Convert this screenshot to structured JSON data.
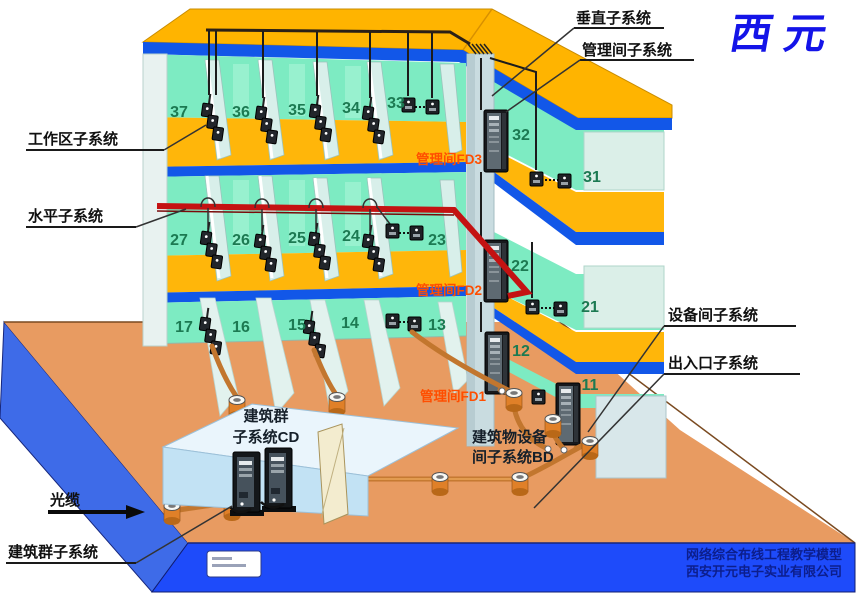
{
  "brand": {
    "name": "西元",
    "color": "#1414E8"
  },
  "callouts": {
    "vertical": "垂直子系统",
    "management": "管理间子系统",
    "work_area": "工作区子系统",
    "horizontal": "水平子系统",
    "equipment_room": "设备间子系统",
    "entrance": "出入口子系统",
    "campus": "建筑群子系统",
    "optical_cable": "光缆"
  },
  "floor_labels": {
    "fd3": "管理间FD3",
    "fd2": "管理间FD2",
    "fd1": "管理间FD1"
  },
  "buildings": {
    "cd": {
      "line1": "建筑群",
      "line2": "子系统CD"
    },
    "bd": {
      "line1": "建筑物设备",
      "line2": "间子系统BD"
    }
  },
  "floors": [
    {
      "name": "FD3",
      "rooms": [
        "37",
        "36",
        "35",
        "34",
        "33",
        "32",
        "31"
      ]
    },
    {
      "name": "FD2",
      "rooms": [
        "27",
        "26",
        "25",
        "24",
        "23",
        "22",
        "21"
      ]
    },
    {
      "name": "FD1",
      "rooms": [
        "17",
        "16",
        "15",
        "14",
        "13",
        "12",
        "11"
      ]
    }
  ],
  "footer": {
    "line1": "网络综合布线工程教学模型",
    "line2": "西安开元电子实业有限公司"
  },
  "colors": {
    "floor_slab": "#FFB60A",
    "floor_edge": "#1257E8",
    "back_wall": "#7DEBC2",
    "ground": "#E89B61",
    "base_front": "#1E4BFA",
    "base_side": "#3E6BE8",
    "horizontal_cable": "#C41212",
    "conduit": "#C2762E"
  }
}
